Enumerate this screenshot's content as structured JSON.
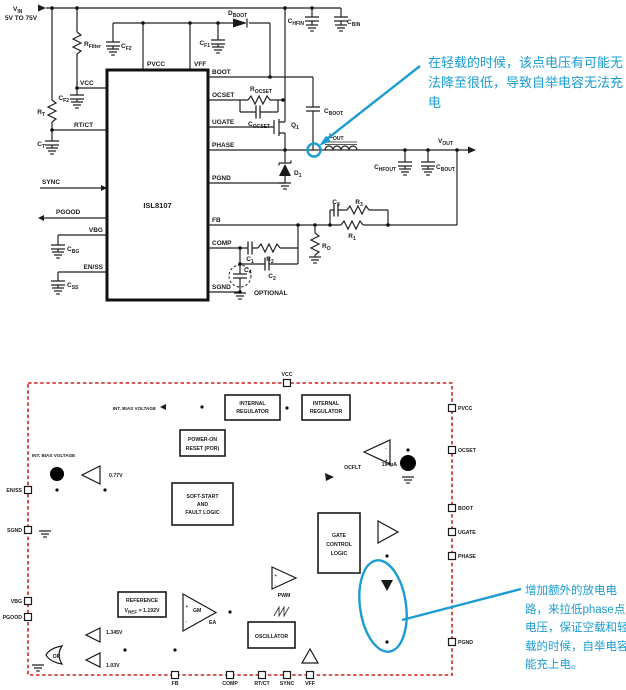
{
  "colors": {
    "accent_cyan": "#1b9cd3",
    "boundary_red": "#cc2222",
    "line": "#1a1a1a",
    "background": "#ffffff"
  },
  "fig1": {
    "chip_name": "ISL8107",
    "vin": {
      "m": "V",
      "s": "IN"
    },
    "vin_range": "5V TO 75V",
    "pins": {
      "pvcc": "PVCC",
      "vff": "VFF",
      "vcc": "VCC",
      "rtct": "RT/CT",
      "sync": "SYNC",
      "pgood": "PGOOD",
      "vbg": "VBG",
      "enss": "EN/SS",
      "boot": "BOOT",
      "ocset": "OCSET",
      "ugate": "UGATE",
      "phase": "PHASE",
      "pgnd": "PGND",
      "fb": "FB",
      "comp": "COMP",
      "sgnd": "SGND"
    },
    "parts": {
      "rfilter": {
        "m": "R",
        "s": "Filter"
      },
      "cf2top": {
        "m": "C",
        "s": "F2"
      },
      "cf2left": {
        "m": "C",
        "s": "F2"
      },
      "cf1": {
        "m": "C",
        "s": "F1"
      },
      "dboot": {
        "m": "D",
        "s": "BOOT"
      },
      "chfin": {
        "m": "C",
        "s": "HFIN"
      },
      "cbin": {
        "m": "C",
        "s": "BIN"
      },
      "rt": {
        "m": "R",
        "s": "T"
      },
      "ct": {
        "m": "C",
        "s": "T"
      },
      "cbg": {
        "m": "C",
        "s": "BG"
      },
      "css": {
        "m": "C",
        "s": "SS"
      },
      "rocset": {
        "m": "R",
        "s": "OCSET"
      },
      "cocset": {
        "m": "C",
        "s": "OCSET"
      },
      "q1": {
        "m": "Q",
        "s": "1"
      },
      "d1": {
        "m": "D",
        "s": "1"
      },
      "cboot": {
        "m": "C",
        "s": "BOOT"
      },
      "lout": {
        "m": "L",
        "s": "OUT"
      },
      "vout": {
        "m": "V",
        "s": "OUT"
      },
      "chfout": {
        "m": "C",
        "s": "HFOUT"
      },
      "cbout": {
        "m": "C",
        "s": "BOUT"
      },
      "c3": {
        "m": "C",
        "s": "3"
      },
      "r3": {
        "m": "R",
        "s": "3"
      },
      "r1": {
        "m": "R",
        "s": "1"
      },
      "ro": {
        "m": "R",
        "s": "O"
      },
      "c1": {
        "m": "C",
        "s": "1"
      },
      "r2": {
        "m": "R",
        "s": "2"
      },
      "c2": {
        "m": "C",
        "s": "2"
      },
      "c4": {
        "m": "C",
        "s": "4"
      }
    },
    "optional_label": "OPTIONAL"
  },
  "fig2": {
    "pins": {
      "vcc": "VCC",
      "pvcc": "PVCC",
      "ocset": "OCSET",
      "boot": "BOOT",
      "ugate": "UGATE",
      "phase": "PHASE",
      "pgnd": "PGND",
      "enss": "EN/SS",
      "sgnd": "SGND",
      "vbg": "VBG",
      "pgood": "PGOOD",
      "fb": "FB",
      "comp": "COMP",
      "rtct": "RT/CT",
      "sync": "SYNC",
      "vff": "VFF"
    },
    "blocks": {
      "int_bias": "INT. BIAS VOLTAGE",
      "reg_l1": "INTERNAL",
      "reg_l2": "REGULATOR",
      "por_l1": "POWER-ON",
      "por_l2": "RESET (POR)",
      "ss_l1": "SOFT-START",
      "ss_l2": "AND",
      "ss_l3": "FAULT LOGIC",
      "ref_l1": "REFERENCE",
      "ref_vm": "V",
      "ref_vs": "REF",
      "ref_vr": " = 1.192V",
      "gcl_l1": "GATE",
      "gcl_l2": "CONTROL",
      "gcl_l3": "LOGIC",
      "osc": "OSCILLATOR",
      "or_gate": "OR",
      "gm": "GM",
      "ea": "EA",
      "pwm": "PWM",
      "ocflt": "OCFLT"
    },
    "values": {
      "current": "194µA",
      "en_th": "0.77V",
      "pg_hi": "1.345V",
      "pg_lo": "1.03V"
    },
    "signs": {
      "plus": "+",
      "minus": "-"
    }
  },
  "annotations": {
    "top": {
      "l1": "在轻载的时候，该点电压有可能无",
      "l2": "法降至很低，导致自举电容无法充",
      "l3": "电"
    },
    "bottom": {
      "l1": "增加额外的放电电",
      "l2": "路，来拉低phase点",
      "l3": "电压，保证空载和轻",
      "l4": "载的时候，自举电容",
      "l5": "能充上电。"
    }
  }
}
